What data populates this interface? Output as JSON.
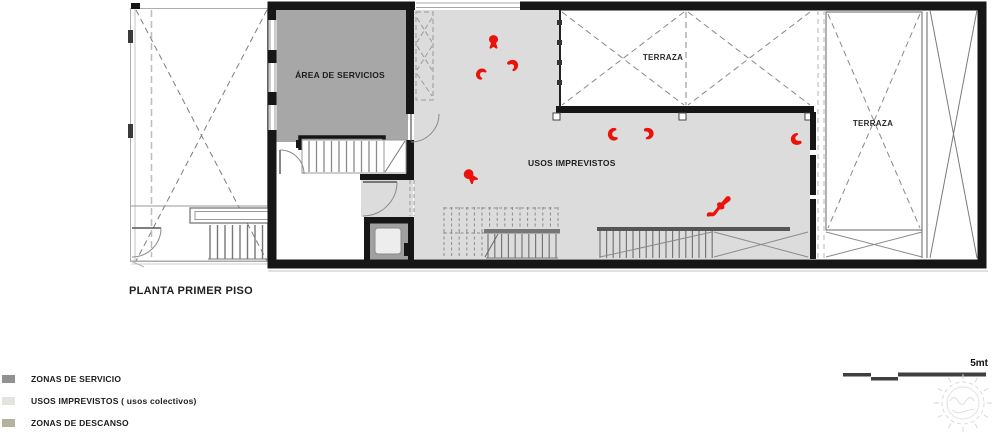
{
  "colors": {
    "wall": "#1a1a1a",
    "service_fill": "#a7a7a7",
    "flex_fill": "#dcdcdc",
    "figure_red": "#e9130c"
  },
  "plan": {
    "title": "PLANTA PRIMER PISO",
    "room_labels": {
      "service_area": "ÁREA DE SERVICIOS",
      "terrace_top": "TERRAZA",
      "terrace_right": "TERRAZA",
      "flexible_uses": "USOS IMPREVISTOS"
    },
    "figures": [
      {
        "x": 482,
        "y": 32,
        "v": "sit-front",
        "r": 0,
        "s": 23
      },
      {
        "x": 501,
        "y": 55,
        "v": "chair-right",
        "r": -15,
        "s": 23
      },
      {
        "x": 470,
        "y": 63,
        "v": "chair-left",
        "r": 30,
        "s": 21
      },
      {
        "x": 601,
        "y": 123,
        "v": "chair-left",
        "r": -10,
        "s": 23
      },
      {
        "x": 636,
        "y": 123,
        "v": "chair-right",
        "r": 10,
        "s": 23
      },
      {
        "x": 785,
        "y": 126,
        "v": "chair-right",
        "r": 180,
        "s": 24
      },
      {
        "x": 459,
        "y": 165,
        "v": "sit-front",
        "r": -40,
        "s": 25
      },
      {
        "x": 704,
        "y": 190,
        "v": "lying",
        "r": 0,
        "s": 33
      }
    ]
  },
  "legend": {
    "items": [
      {
        "label": "ZONAS DE SERVICIO",
        "color": "#919191"
      },
      {
        "label": "USOS IMPREVISTOS ( usos colectivos)",
        "color": "#e3e3e0"
      },
      {
        "label": "ZONAS DE DESCANSO",
        "color": "#b3b29d"
      }
    ]
  },
  "scale_bar": {
    "label": "5mt"
  }
}
